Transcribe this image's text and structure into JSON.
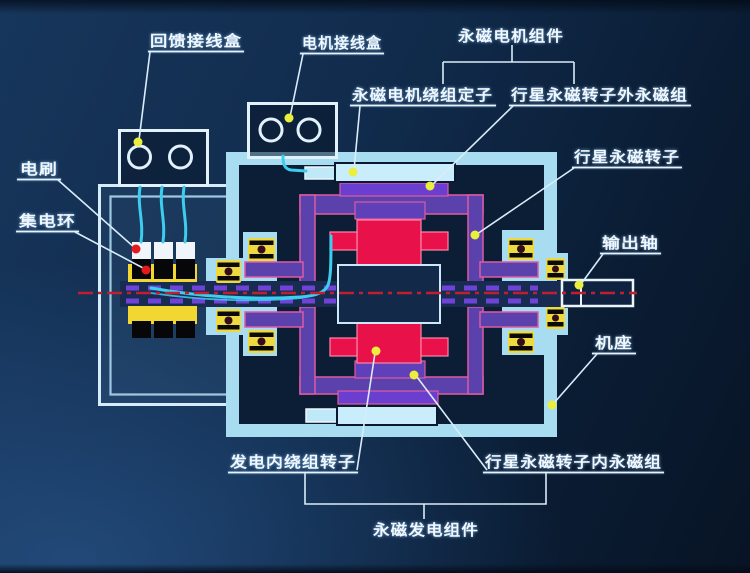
{
  "labels": {
    "feedback_junction_box": "回馈接线盒",
    "motor_junction_box": "电机接线盒",
    "pm_motor_assembly": "永磁电机组件",
    "pm_motor_stator_winding": "永磁电机绕组定子",
    "planet_rotor_outer_pm": "行星永磁转子外永磁组",
    "planet_pm_rotor": "行星永磁转子",
    "brush": "电刷",
    "slip_ring": "集电环",
    "output_shaft": "输出轴",
    "machine_frame": "机座",
    "gen_inner_winding_rotor": "发电内绕组转子",
    "planet_rotor_inner_pm": "行星永磁转子内永磁组",
    "pm_generator_assembly": "永磁发电组件"
  },
  "colors": {
    "background_dark": "#0a1c33",
    "background_light": "#17365c",
    "casing_cyan": "#a8ddf1",
    "winding_cyan": "#c9edfb",
    "rotor_frame_purple": "#5a41ab",
    "pm_group_violet": "#6a3fd0",
    "frame_outline_pink": "#dd5ba4",
    "magnet_red": "#e81149",
    "slip_ring_yellow": "#f2d733",
    "bearing_yellow": "#eed93f",
    "wire_cyan": "#3dcdef",
    "centerline_red": "#c21f2e",
    "leader_dot_yellow": "#e9ef3c",
    "leader_dot_red": "#e51a1f",
    "label_white": "#f0f7fd"
  }
}
